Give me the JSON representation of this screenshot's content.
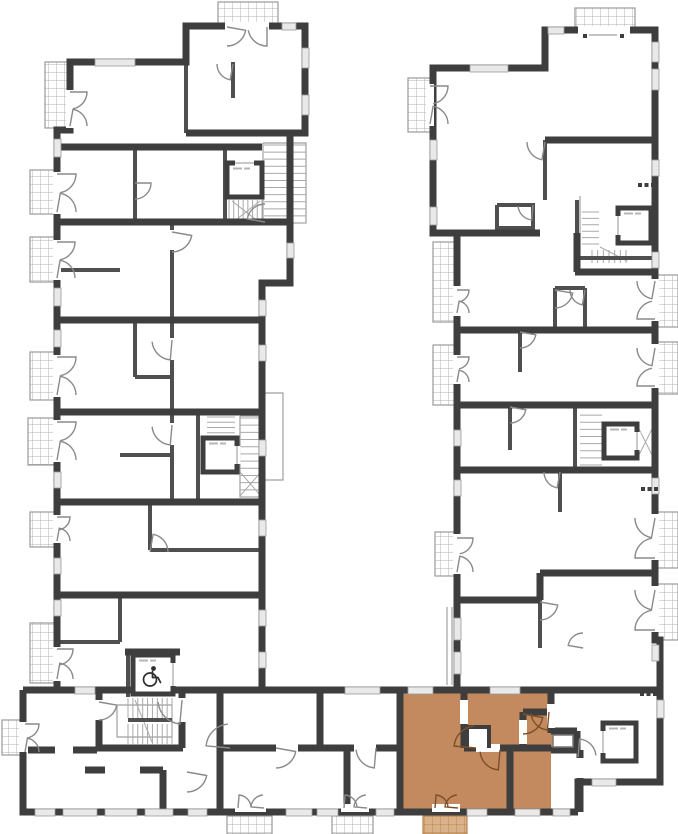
{
  "plan": {
    "width": 678,
    "height": 834,
    "palette": {
      "background": "#ffffff",
      "wall_dark": "#3e3e3e",
      "wall_mid": "#4f4f4f",
      "thin_line": "#9f9f9f",
      "stair_line": "#a9a9a9",
      "window_fill": "#e9e9e9",
      "window_edge": "#999999",
      "arc_line": "#8a8a8a",
      "hatch_line": "#b0b0b0",
      "hatch_edge": "#9a9a9a",
      "highlight_fill": "#c28a5e",
      "highlight_balcony": "#d9b28a",
      "highlight_hatch": "#b8854f",
      "highlight_arc": "#7d4f28",
      "icon_dark": "#2e2e2e"
    },
    "walls_dark": [
      "M57,690 L57,130 L70,130 L70,62 L186,62 L186,26 L305,26 L305,133 L290,133 L290,283 L262,283 L262,690",
      "M186,133 L290,133",
      "M57,147 L262,147",
      "M57,222 L290,222",
      "M57,320 L262,320",
      "M57,412 L262,412",
      "M57,502 L262,502",
      "M57,595 L262,595",
      "M457,690 L457,233 L433,233 L433,68 L545,68 L545,30 L655,30 L655,640 L660,640 L660,782 L578,782 L578,812",
      "M545,140 L655,140",
      "M433,233 L540,233",
      "M577,233 L577,272",
      "M575,272 L652,272",
      "M457,330 L655,330",
      "M457,405 L655,405",
      "M457,470 L655,470",
      "M457,600 L540,600",
      "M540,573 L655,573",
      "M540,573 L540,600",
      "M23,690 L660,690",
      "M23,690 L23,812 L578,812",
      "M125,652 L180,652",
      "M99,690 L99,748",
      "M182,692 L182,748",
      "M97,748 L183,748",
      "M28,750 L97,750",
      "M85,770 L105,770",
      "M140,770 L163,770",
      "M163,770 L163,812",
      "M220,690 L220,812",
      "M220,748 L400,748",
      "M347,748 L347,812",
      "M320,690 L320,748",
      "M400,690 L400,812",
      "M464,690 L464,748",
      "M464,748 L551,748",
      "M523,712 L523,748",
      "M523,712 L551,712",
      "M510,748 L510,812",
      "M551,690 L551,733",
      "M551,731 L577,731",
      "M577,731 L577,752",
      "M551,750 L577,750",
      "M580,750 L580,812"
    ],
    "walls_mid": [
      "M135,147 L135,222",
      "M57,270 L120,270",
      "M172,222 L172,502",
      "M135,320 L135,377",
      "M135,377 L172,377",
      "M120,455 L172,455",
      "M150,502 L150,550",
      "M150,550 L262,550",
      "M120,595 L120,642",
      "M57,642 L120,642",
      "M233,62 L233,98",
      "M186,62 L186,133",
      "M128,720 L172,720",
      "M225,147 L225,222",
      "M198,412 L198,502",
      "M577,200 L577,258",
      "M577,258 L652,258",
      "M575,405 L575,470",
      "M497,205 L533,205 L533,228 L497,228 L497,205",
      "M545,140 L545,200",
      "M555,288 L585,288",
      "M555,288 L555,330",
      "M585,288 L585,330",
      "M520,330 L520,372",
      "M510,405 L510,450",
      "M560,470 L560,512",
      "M540,600 L540,648",
      "M128,652 L128,697"
    ],
    "walls_thin": [
      "M263,143 L306,143 L306,223 L263,223 L263,143",
      "M240,416 L262,416 L262,497 L240,497 L240,416",
      "M117,705 L172,705 L172,737 L117,737 L117,705",
      "M580,196 L580,258",
      "M262,393 L283,393 L283,480 L262,480 L262,393",
      "M447,607 L447,685",
      "M452,607 L452,685",
      "M589,35 L617,35"
    ],
    "stair_diagonals": [
      "M232,201 L260,223",
      "M232,223 L260,201",
      "M240,472 L261,496",
      "M240,496 L261,472",
      "M638,427 L653,457",
      "M638,457 L653,427",
      "M600,247 L627,261",
      "M135,700 L152,742"
    ],
    "balconies": [
      [
        218,
        2,
        60,
        22,
        0
      ],
      [
        45,
        62,
        25,
        66,
        0
      ],
      [
        30,
        170,
        27,
        44,
        0
      ],
      [
        30,
        237,
        27,
        45,
        0
      ],
      [
        30,
        352,
        27,
        48,
        0
      ],
      [
        28,
        418,
        27,
        47,
        0
      ],
      [
        30,
        512,
        27,
        35,
        0
      ],
      [
        30,
        623,
        25,
        60,
        0
      ],
      [
        2,
        720,
        23,
        35,
        0
      ],
      [
        575,
        8,
        60,
        22,
        0
      ],
      [
        408,
        78,
        24,
        54,
        0
      ],
      [
        433,
        242,
        24,
        80,
        0
      ],
      [
        433,
        345,
        24,
        60,
        0
      ],
      [
        435,
        532,
        23,
        44,
        0
      ],
      [
        655,
        275,
        23,
        52,
        0
      ],
      [
        655,
        342,
        23,
        52,
        0
      ],
      [
        655,
        512,
        23,
        56,
        0
      ],
      [
        655,
        584,
        23,
        56,
        0
      ],
      [
        227,
        816,
        45,
        18,
        0
      ],
      [
        332,
        816,
        41,
        18,
        0
      ],
      [
        423,
        816,
        44,
        18,
        1
      ]
    ],
    "windows": [
      [
        95,
        59,
        40,
        7
      ],
      [
        282,
        23,
        14,
        7
      ],
      [
        302,
        48,
        7,
        20
      ],
      [
        302,
        95,
        7,
        20
      ],
      [
        54,
        139,
        7,
        18
      ],
      [
        54,
        288,
        7,
        18
      ],
      [
        54,
        330,
        7,
        17
      ],
      [
        54,
        472,
        7,
        16
      ],
      [
        54,
        558,
        7,
        16
      ],
      [
        54,
        600,
        7,
        16
      ],
      [
        287,
        243,
        7,
        15
      ],
      [
        259,
        300,
        7,
        16
      ],
      [
        259,
        345,
        7,
        16
      ],
      [
        259,
        440,
        7,
        16
      ],
      [
        259,
        520,
        7,
        16
      ],
      [
        259,
        610,
        7,
        16
      ],
      [
        259,
        652,
        7,
        16
      ],
      [
        430,
        140,
        7,
        20
      ],
      [
        430,
        207,
        7,
        18
      ],
      [
        454,
        430,
        7,
        16
      ],
      [
        454,
        480,
        7,
        16
      ],
      [
        454,
        618,
        7,
        22
      ],
      [
        454,
        652,
        7,
        22
      ],
      [
        470,
        65,
        38,
        7
      ],
      [
        548,
        27,
        16,
        7
      ],
      [
        652,
        42,
        7,
        20
      ],
      [
        652,
        69,
        7,
        21
      ],
      [
        652,
        160,
        7,
        16
      ],
      [
        652,
        252,
        7,
        16
      ],
      [
        652,
        478,
        7,
        16
      ],
      [
        652,
        645,
        7,
        16
      ],
      [
        35,
        809,
        20,
        7
      ],
      [
        63,
        809,
        34,
        7
      ],
      [
        105,
        809,
        32,
        7
      ],
      [
        145,
        809,
        28,
        7
      ],
      [
        188,
        809,
        19,
        7
      ],
      [
        286,
        809,
        26,
        7
      ],
      [
        317,
        809,
        21,
        7
      ],
      [
        376,
        809,
        18,
        7
      ],
      [
        467,
        809,
        20,
        7
      ],
      [
        515,
        809,
        25,
        7
      ],
      [
        553,
        809,
        17,
        7
      ],
      [
        345,
        687,
        35,
        7
      ],
      [
        408,
        687,
        25,
        7
      ],
      [
        490,
        687,
        30,
        7
      ],
      [
        75,
        687,
        20,
        7
      ],
      [
        657,
        700,
        7,
        18
      ],
      [
        592,
        779,
        24,
        7
      ]
    ],
    "door_gaps": [
      [
        66,
        90,
        8,
        38
      ],
      [
        53,
        172,
        8,
        42
      ],
      [
        53,
        240,
        8,
        40
      ],
      [
        53,
        355,
        8,
        42
      ],
      [
        53,
        420,
        8,
        42
      ],
      [
        53,
        515,
        8,
        28
      ],
      [
        53,
        647,
        8,
        34
      ],
      [
        225,
        22,
        44,
        8
      ],
      [
        578,
        26,
        52,
        8
      ],
      [
        426,
        84,
        8,
        42
      ],
      [
        453,
        286,
        8,
        30
      ],
      [
        453,
        355,
        8,
        29
      ],
      [
        453,
        534,
        8,
        40
      ],
      [
        651,
        279,
        8,
        42
      ],
      [
        651,
        344,
        8,
        44
      ],
      [
        651,
        514,
        8,
        46
      ],
      [
        651,
        586,
        8,
        46
      ],
      [
        235,
        804,
        31,
        8
      ],
      [
        341,
        804,
        28,
        8
      ],
      [
        432,
        804,
        28,
        8
      ],
      [
        168,
        338,
        8,
        22
      ],
      [
        168,
        423,
        8,
        22
      ],
      [
        168,
        230,
        8,
        20
      ],
      [
        276,
        744,
        22,
        8
      ],
      [
        354,
        744,
        22,
        8
      ],
      [
        460,
        700,
        8,
        24
      ],
      [
        476,
        744,
        24,
        8
      ],
      [
        519,
        720,
        8,
        24
      ],
      [
        547,
        704,
        8,
        24
      ],
      [
        95,
        700,
        8,
        20
      ],
      [
        178,
        698,
        8,
        24
      ],
      [
        55,
        746,
        18,
        8
      ],
      [
        576,
        758,
        8,
        20
      ],
      [
        19,
        722,
        8,
        30
      ]
    ],
    "door_arcs": [
      [
        70,
        92,
        17,
        0,
        80,
        0
      ],
      [
        70,
        126,
        17,
        -80,
        0,
        0
      ],
      [
        57,
        174,
        19,
        0,
        80,
        0
      ],
      [
        57,
        212,
        19,
        -80,
        0,
        0
      ],
      [
        57,
        242,
        18,
        0,
        80,
        0
      ],
      [
        57,
        278,
        18,
        -80,
        0,
        0
      ],
      [
        57,
        357,
        19,
        0,
        80,
        0
      ],
      [
        57,
        395,
        19,
        -80,
        0,
        0
      ],
      [
        57,
        422,
        19,
        0,
        80,
        0
      ],
      [
        57,
        460,
        19,
        -80,
        0,
        0
      ],
      [
        57,
        517,
        13,
        0,
        80,
        0
      ],
      [
        57,
        541,
        13,
        -80,
        0,
        0
      ],
      [
        57,
        649,
        16,
        0,
        80,
        0
      ],
      [
        57,
        679,
        16,
        -80,
        0,
        0
      ],
      [
        227,
        27,
        19,
        10,
        90,
        0
      ],
      [
        267,
        27,
        19,
        90,
        170,
        0
      ],
      [
        430,
        86,
        18,
        0,
        80,
        0
      ],
      [
        430,
        124,
        18,
        -80,
        0,
        0
      ],
      [
        457,
        290,
        12,
        0,
        80,
        0
      ],
      [
        457,
        313,
        12,
        -80,
        0,
        0
      ],
      [
        457,
        357,
        12,
        0,
        80,
        0
      ],
      [
        457,
        382,
        12,
        -80,
        0,
        0
      ],
      [
        457,
        538,
        16,
        0,
        80,
        0
      ],
      [
        457,
        572,
        16,
        -80,
        0,
        0
      ],
      [
        655,
        281,
        18,
        100,
        180,
        0
      ],
      [
        655,
        319,
        18,
        180,
        260,
        0
      ],
      [
        655,
        348,
        18,
        100,
        180,
        0
      ],
      [
        655,
        386,
        18,
        180,
        260,
        0
      ],
      [
        655,
        518,
        20,
        100,
        180,
        0
      ],
      [
        655,
        558,
        20,
        180,
        260,
        0
      ],
      [
        655,
        590,
        20,
        100,
        180,
        0
      ],
      [
        655,
        630,
        20,
        180,
        260,
        0
      ],
      [
        238,
        808,
        13,
        275,
        355,
        0
      ],
      [
        264,
        808,
        13,
        185,
        265,
        0
      ],
      [
        344,
        808,
        13,
        275,
        355,
        0
      ],
      [
        367,
        808,
        13,
        185,
        265,
        0
      ],
      [
        25,
        724,
        14,
        0,
        80,
        0
      ],
      [
        25,
        752,
        14,
        -80,
        0,
        0
      ],
      [
        135,
        183,
        16,
        0,
        90,
        0
      ],
      [
        172,
        340,
        20,
        95,
        175,
        0
      ],
      [
        172,
        425,
        20,
        95,
        175,
        0
      ],
      [
        172,
        232,
        20,
        10,
        90,
        0
      ],
      [
        150,
        552,
        18,
        280,
        360,
        0
      ],
      [
        182,
        700,
        24,
        95,
        175,
        0
      ],
      [
        230,
        748,
        24,
        185,
        265,
        0
      ],
      [
        99,
        702,
        18,
        10,
        90,
        0
      ],
      [
        187,
        772,
        20,
        10,
        90,
        0
      ],
      [
        233,
        64,
        16,
        100,
        180,
        0
      ],
      [
        265,
        222,
        18,
        190,
        270,
        0
      ],
      [
        545,
        142,
        18,
        100,
        180,
        0
      ],
      [
        533,
        205,
        15,
        95,
        175,
        0
      ],
      [
        555,
        290,
        18,
        10,
        90,
        0
      ],
      [
        585,
        290,
        15,
        100,
        180,
        0
      ],
      [
        520,
        332,
        16,
        10,
        90,
        0
      ],
      [
        510,
        407,
        16,
        10,
        90,
        0
      ],
      [
        560,
        472,
        16,
        100,
        180,
        0
      ],
      [
        540,
        602,
        18,
        10,
        90,
        0
      ],
      [
        583,
        648,
        15,
        190,
        270,
        0
      ],
      [
        578,
        757,
        18,
        275,
        355,
        0
      ],
      [
        276,
        748,
        20,
        10,
        90,
        0
      ],
      [
        376,
        748,
        20,
        95,
        175,
        0
      ],
      [
        476,
        748,
        22,
        185,
        265,
        1
      ],
      [
        500,
        750,
        20,
        95,
        175,
        1
      ],
      [
        523,
        714,
        20,
        10,
        90,
        1
      ],
      [
        549,
        712,
        18,
        95,
        175,
        1
      ],
      [
        435,
        808,
        13,
        275,
        355,
        1
      ],
      [
        458,
        808,
        13,
        185,
        265,
        1
      ]
    ],
    "stairs": [
      [
        264,
        145,
        42,
        78,
        "v",
        11
      ],
      [
        229,
        200,
        33,
        24,
        "h",
        7
      ],
      [
        207,
        417,
        28,
        21,
        "v",
        4
      ],
      [
        240,
        418,
        22,
        79,
        "v",
        11
      ],
      [
        582,
        212,
        17,
        32,
        "v",
        5
      ],
      [
        592,
        250,
        34,
        13,
        "h",
        6
      ],
      [
        580,
        408,
        22,
        57,
        "v",
        8
      ],
      [
        128,
        698,
        44,
        20,
        "h",
        9
      ],
      [
        128,
        724,
        44,
        20,
        "h",
        9
      ]
    ],
    "elevators": [
      [
        227,
        163,
        35,
        34,
        "n",
        0
      ],
      [
        203,
        438,
        34,
        34,
        "e",
        0
      ],
      [
        618,
        208,
        33,
        35,
        "w",
        0
      ],
      [
        604,
        424,
        33,
        34,
        "e",
        0
      ],
      [
        133,
        655,
        40,
        39,
        "e",
        1
      ],
      [
        603,
        723,
        33,
        38,
        "w",
        0
      ]
    ],
    "dots": [
      [
        640,
        692,
        3
      ],
      [
        641,
        487,
        3
      ],
      [
        638,
        183,
        3
      ],
      [
        583,
        34,
        1
      ],
      [
        620,
        34,
        1
      ]
    ],
    "highlight_unit": {
      "rects": [
        [
          401,
          693,
          150,
          117
        ],
        [
          551,
          733,
          26,
          15
        ]
      ],
      "notches": [
        {
          "rect": [
            467,
            727,
            22,
            21
          ],
          "path": "M467,748 L467,727 L489,727 L489,748"
        },
        {
          "rect": [
            553,
            735,
            20,
            12
          ],
          "full": 1
        }
      ]
    },
    "icons": {
      "wheelchair": "wheelchair-accessibility-symbol"
    }
  }
}
